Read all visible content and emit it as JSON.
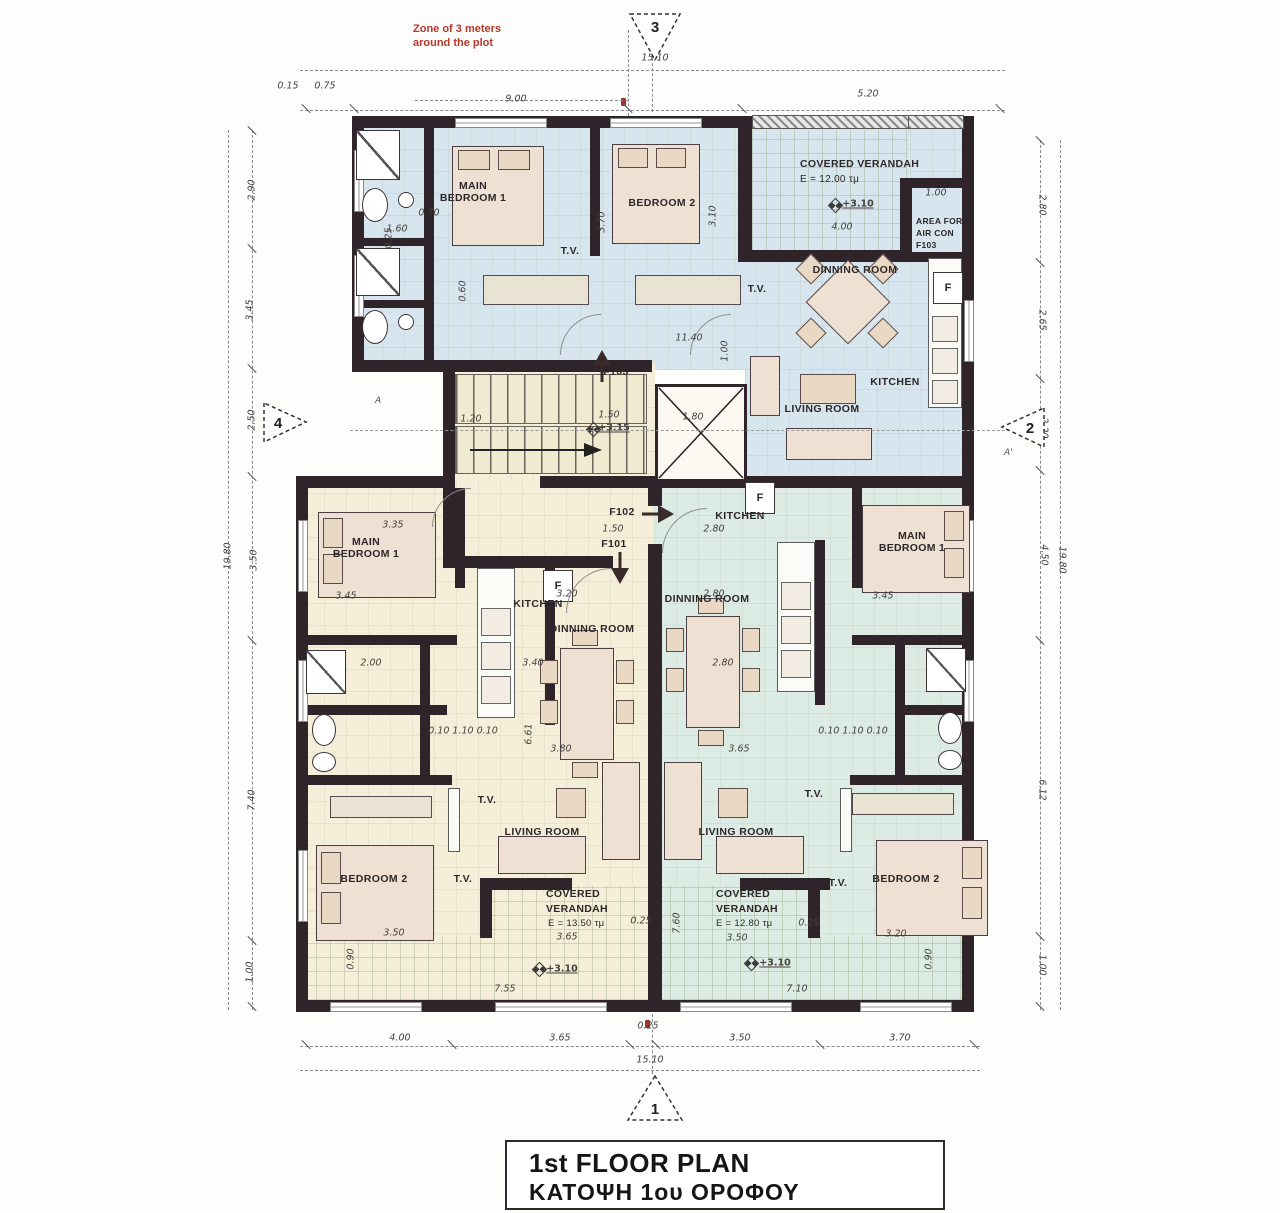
{
  "notes": {
    "zone1": "Zone of 3 meters",
    "zone2": "around the plot"
  },
  "markers": {
    "top": "3",
    "bottom": "1",
    "left": "4",
    "right": "2",
    "a": "A",
    "a_prime": "A'"
  },
  "title": {
    "en": "1st FLOOR PLAN",
    "gr": "ΚΑΤΟΨΗ  1ου ΟΡΟΦΟΥ"
  },
  "core": {
    "f101": "F101",
    "f102": "F102",
    "f103": "F103",
    "level": "+3.15"
  },
  "top_apt": {
    "main_bedroom1": "MAIN",
    "main_bedroom2": "BEDROOM 1",
    "bedroom2": "BEDROOM 2",
    "verandah": "COVERED VERANDAH",
    "verandah_area": "E = 12.00 τμ",
    "verandah_level": "+3.10",
    "verandah_width": "4.00",
    "aircon1": "AREA FOR",
    "aircon2": "AIR CON",
    "aircon3": "F103",
    "dinning": "DINNING ROOM",
    "living": "LIVING ROOM",
    "kitchen": "KITCHEN",
    "tv": "T.V.",
    "fridge": "F"
  },
  "left_apt": {
    "main1": "MAIN",
    "main2": "BEDROOM 1",
    "kitchen": "KITCHEN",
    "dinning": "DINNING ROOM",
    "living": "LIVING ROOM",
    "bedroom2": "BEDROOM 2",
    "ver1": "COVERED",
    "ver2": "VERANDAH",
    "ver_area": "E = 13.50 τμ",
    "ver_level": "+3.10",
    "ver_w": "3.65",
    "ver_total": "7.55",
    "tv": "T.V.",
    "fridge": "F"
  },
  "right_apt": {
    "main1": "MAIN",
    "main2": "BEDROOM 1",
    "kitchen": "KITCHEN",
    "dinning": "DINNING ROOM",
    "living": "LIVING ROOM",
    "bedroom2": "BEDROOM 2",
    "ver1": "COVERED",
    "ver2": "VERANDAH",
    "ver_area": "E = 12.80 τμ",
    "ver_level": "+3.10",
    "ver_w": "3.50",
    "ver_total": "7.10",
    "tv": "T.V.",
    "fridge": "F"
  },
  "dims": {
    "top": {
      "a": "0.15",
      "b": "0.75",
      "c": "9.00",
      "d": "5.20",
      "total": "15.10"
    },
    "bottom": {
      "a": "4.00",
      "b": "3.65",
      "c": "0.25",
      "d": "3.50",
      "e": "3.70",
      "total": "15.10"
    },
    "left": {
      "a": "2.90",
      "b": "3.45",
      "c": "2.50",
      "d": "3.50",
      "e": "7.40",
      "f": "1.00",
      "total": "19.80"
    },
    "right": {
      "a": "2.80",
      "b": "2.65",
      "c": "2.20",
      "d": "4.50",
      "e": "6.12",
      "f": "1.00",
      "total": "19.80"
    },
    "inner": [
      "3.70",
      "0.70",
      "1.60",
      "3.10",
      "0.60",
      "11.40",
      "1.00",
      "1.20",
      "1.50",
      "1.80",
      "1.50",
      "2.80",
      "3.35",
      "3.45",
      "3.45",
      "3.20",
      "2.80",
      "3.40",
      "2.80",
      "6.61",
      "3.80",
      "3.65",
      "0.10 1.10 0.10",
      "0.10 1.10 0.10",
      "3.50",
      "3.20",
      "0.25",
      "0.25",
      "7.60",
      "0.90",
      "0.90",
      "0.25",
      "1.00",
      "2.00"
    ]
  }
}
